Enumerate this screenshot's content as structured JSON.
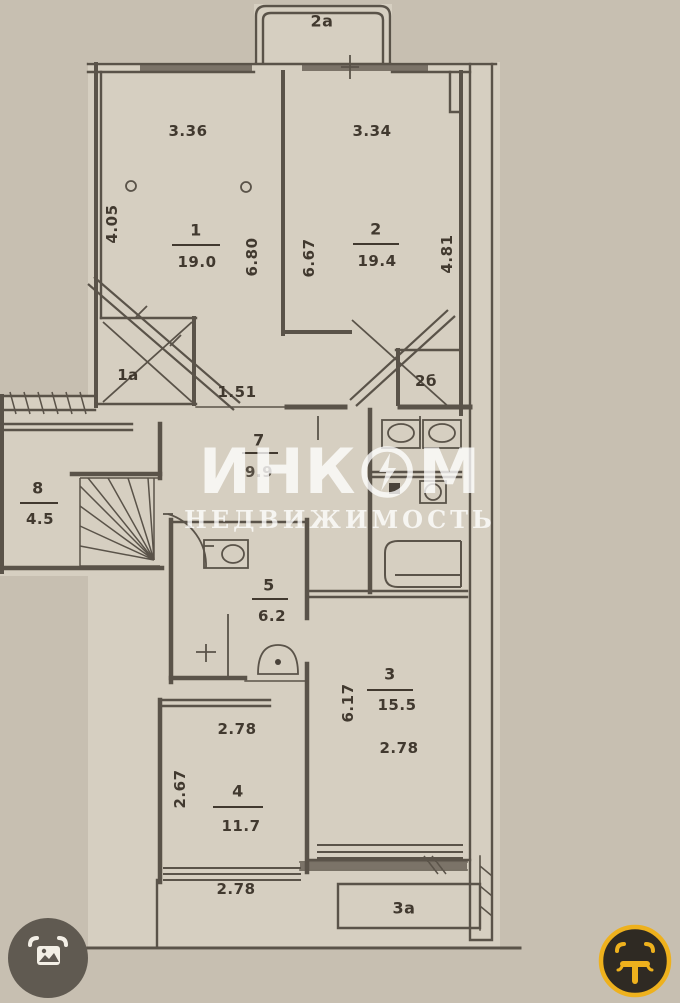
{
  "watermark": {
    "brand_left": "ИНК",
    "brand_right": "М",
    "subtitle": "НЕДВИЖИМОСТЬ"
  },
  "rooms": {
    "balcony_top": {
      "num": "2a"
    },
    "r1": {
      "num": "1",
      "area": "19.0",
      "dim_top": "3.36",
      "dim_left": "4.05",
      "dim_right": "6.80"
    },
    "r1a": {
      "num": "1a"
    },
    "passage": {
      "dim": "1.51"
    },
    "r2": {
      "num": "2",
      "area": "19.4",
      "dim_top": "3.34",
      "dim_left": "6.67",
      "dim_right": "4.81"
    },
    "r2b": {
      "num": "2б"
    },
    "hall": {
      "num": "7",
      "area": "9.9"
    },
    "r8": {
      "num": "8",
      "area": "4.5"
    },
    "r5": {
      "num": "5",
      "area": "6.2"
    },
    "r3": {
      "num": "3",
      "area": "15.5",
      "dim_left": "6.17",
      "dim_width": "2.78"
    },
    "r4": {
      "num": "4",
      "area": "11.7",
      "dim_top": "2.78",
      "dim_left": "2.67",
      "dim_bottom": "2.78"
    },
    "balcony_bottom": {
      "num": "3a"
    }
  },
  "colors": {
    "paper": "#c7bfb1",
    "floor": "#d6cfc1",
    "line": "#5a5349",
    "text": "#41392f",
    "watermark_white": "rgba(255,255,255,0.78)",
    "icon_left_bg": "#605a51",
    "icon_right_bg": "#2f2a23",
    "icon_ring_yellow": "#eeb11d"
  }
}
